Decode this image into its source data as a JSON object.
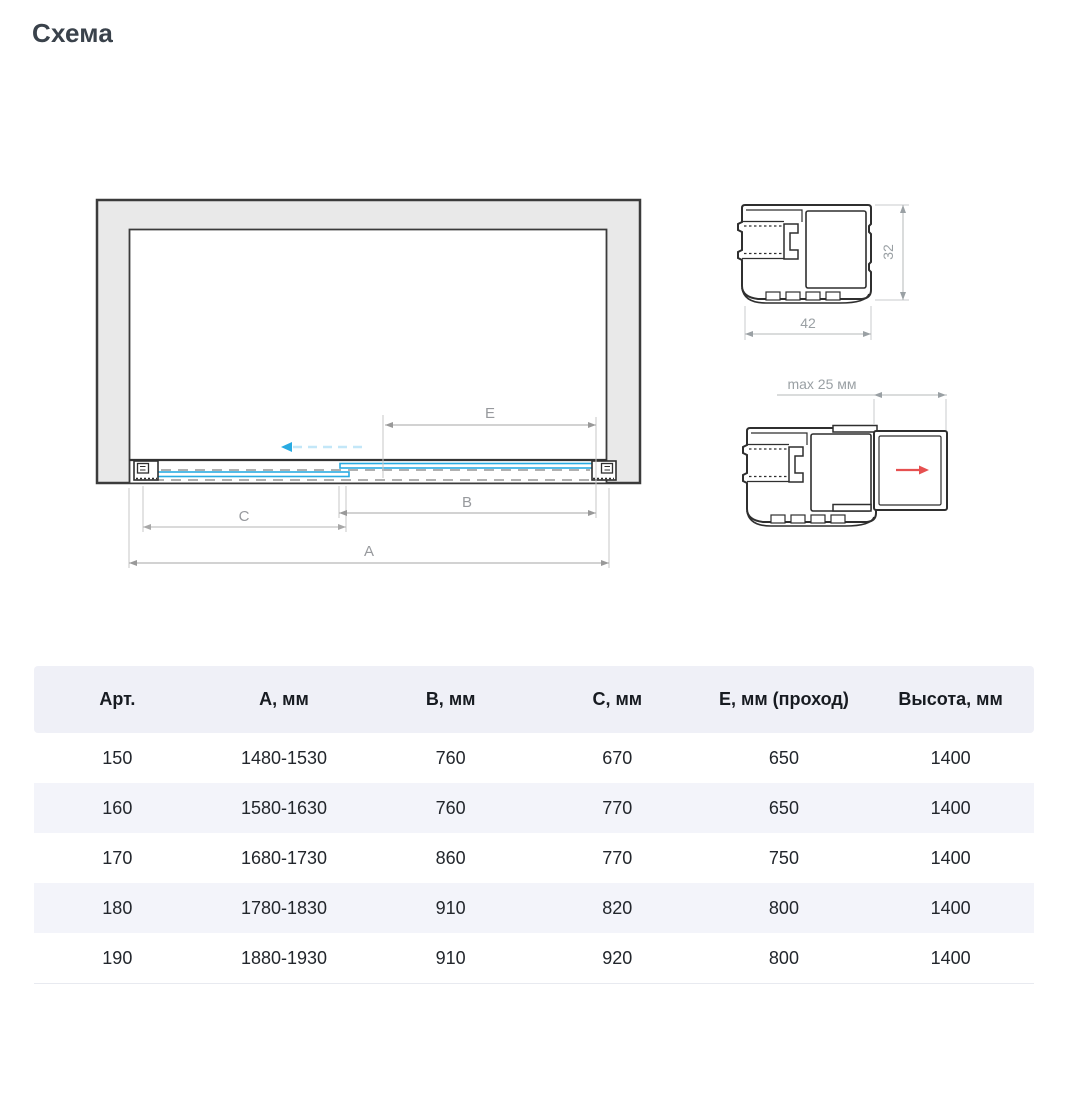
{
  "page": {
    "title": "Схема"
  },
  "colors": {
    "accent_blue": "#29abe2",
    "light_blue_dash": "#c3e7f8",
    "red_arrow": "#e65050",
    "wall_gray": "#e9e9e9",
    "outline_dark": "#3b3b3b",
    "dim_gray": "#9aa0a4",
    "table_header_bg": "#eff0f7",
    "table_stripe_bg": "#f3f4fa"
  },
  "diagram": {
    "dim_labels": {
      "a": "A",
      "b": "B",
      "c": "C",
      "e": "E"
    }
  },
  "profiles": {
    "width_label": "42",
    "height_label": "32",
    "max_gap_label": "max 25 мм"
  },
  "table": {
    "headers": [
      "Арт.",
      "А, мм",
      "В, мм",
      "С, мм",
      "Е, мм (проход)",
      "Высота, мм"
    ],
    "rows": [
      [
        "150",
        "1480-1530",
        "760",
        "670",
        "650",
        "1400"
      ],
      [
        "160",
        "1580-1630",
        "760",
        "770",
        "650",
        "1400"
      ],
      [
        "170",
        "1680-1730",
        "860",
        "770",
        "750",
        "1400"
      ],
      [
        "180",
        "1780-1830",
        "910",
        "820",
        "800",
        "1400"
      ],
      [
        "190",
        "1880-1930",
        "910",
        "920",
        "800",
        "1400"
      ]
    ]
  }
}
